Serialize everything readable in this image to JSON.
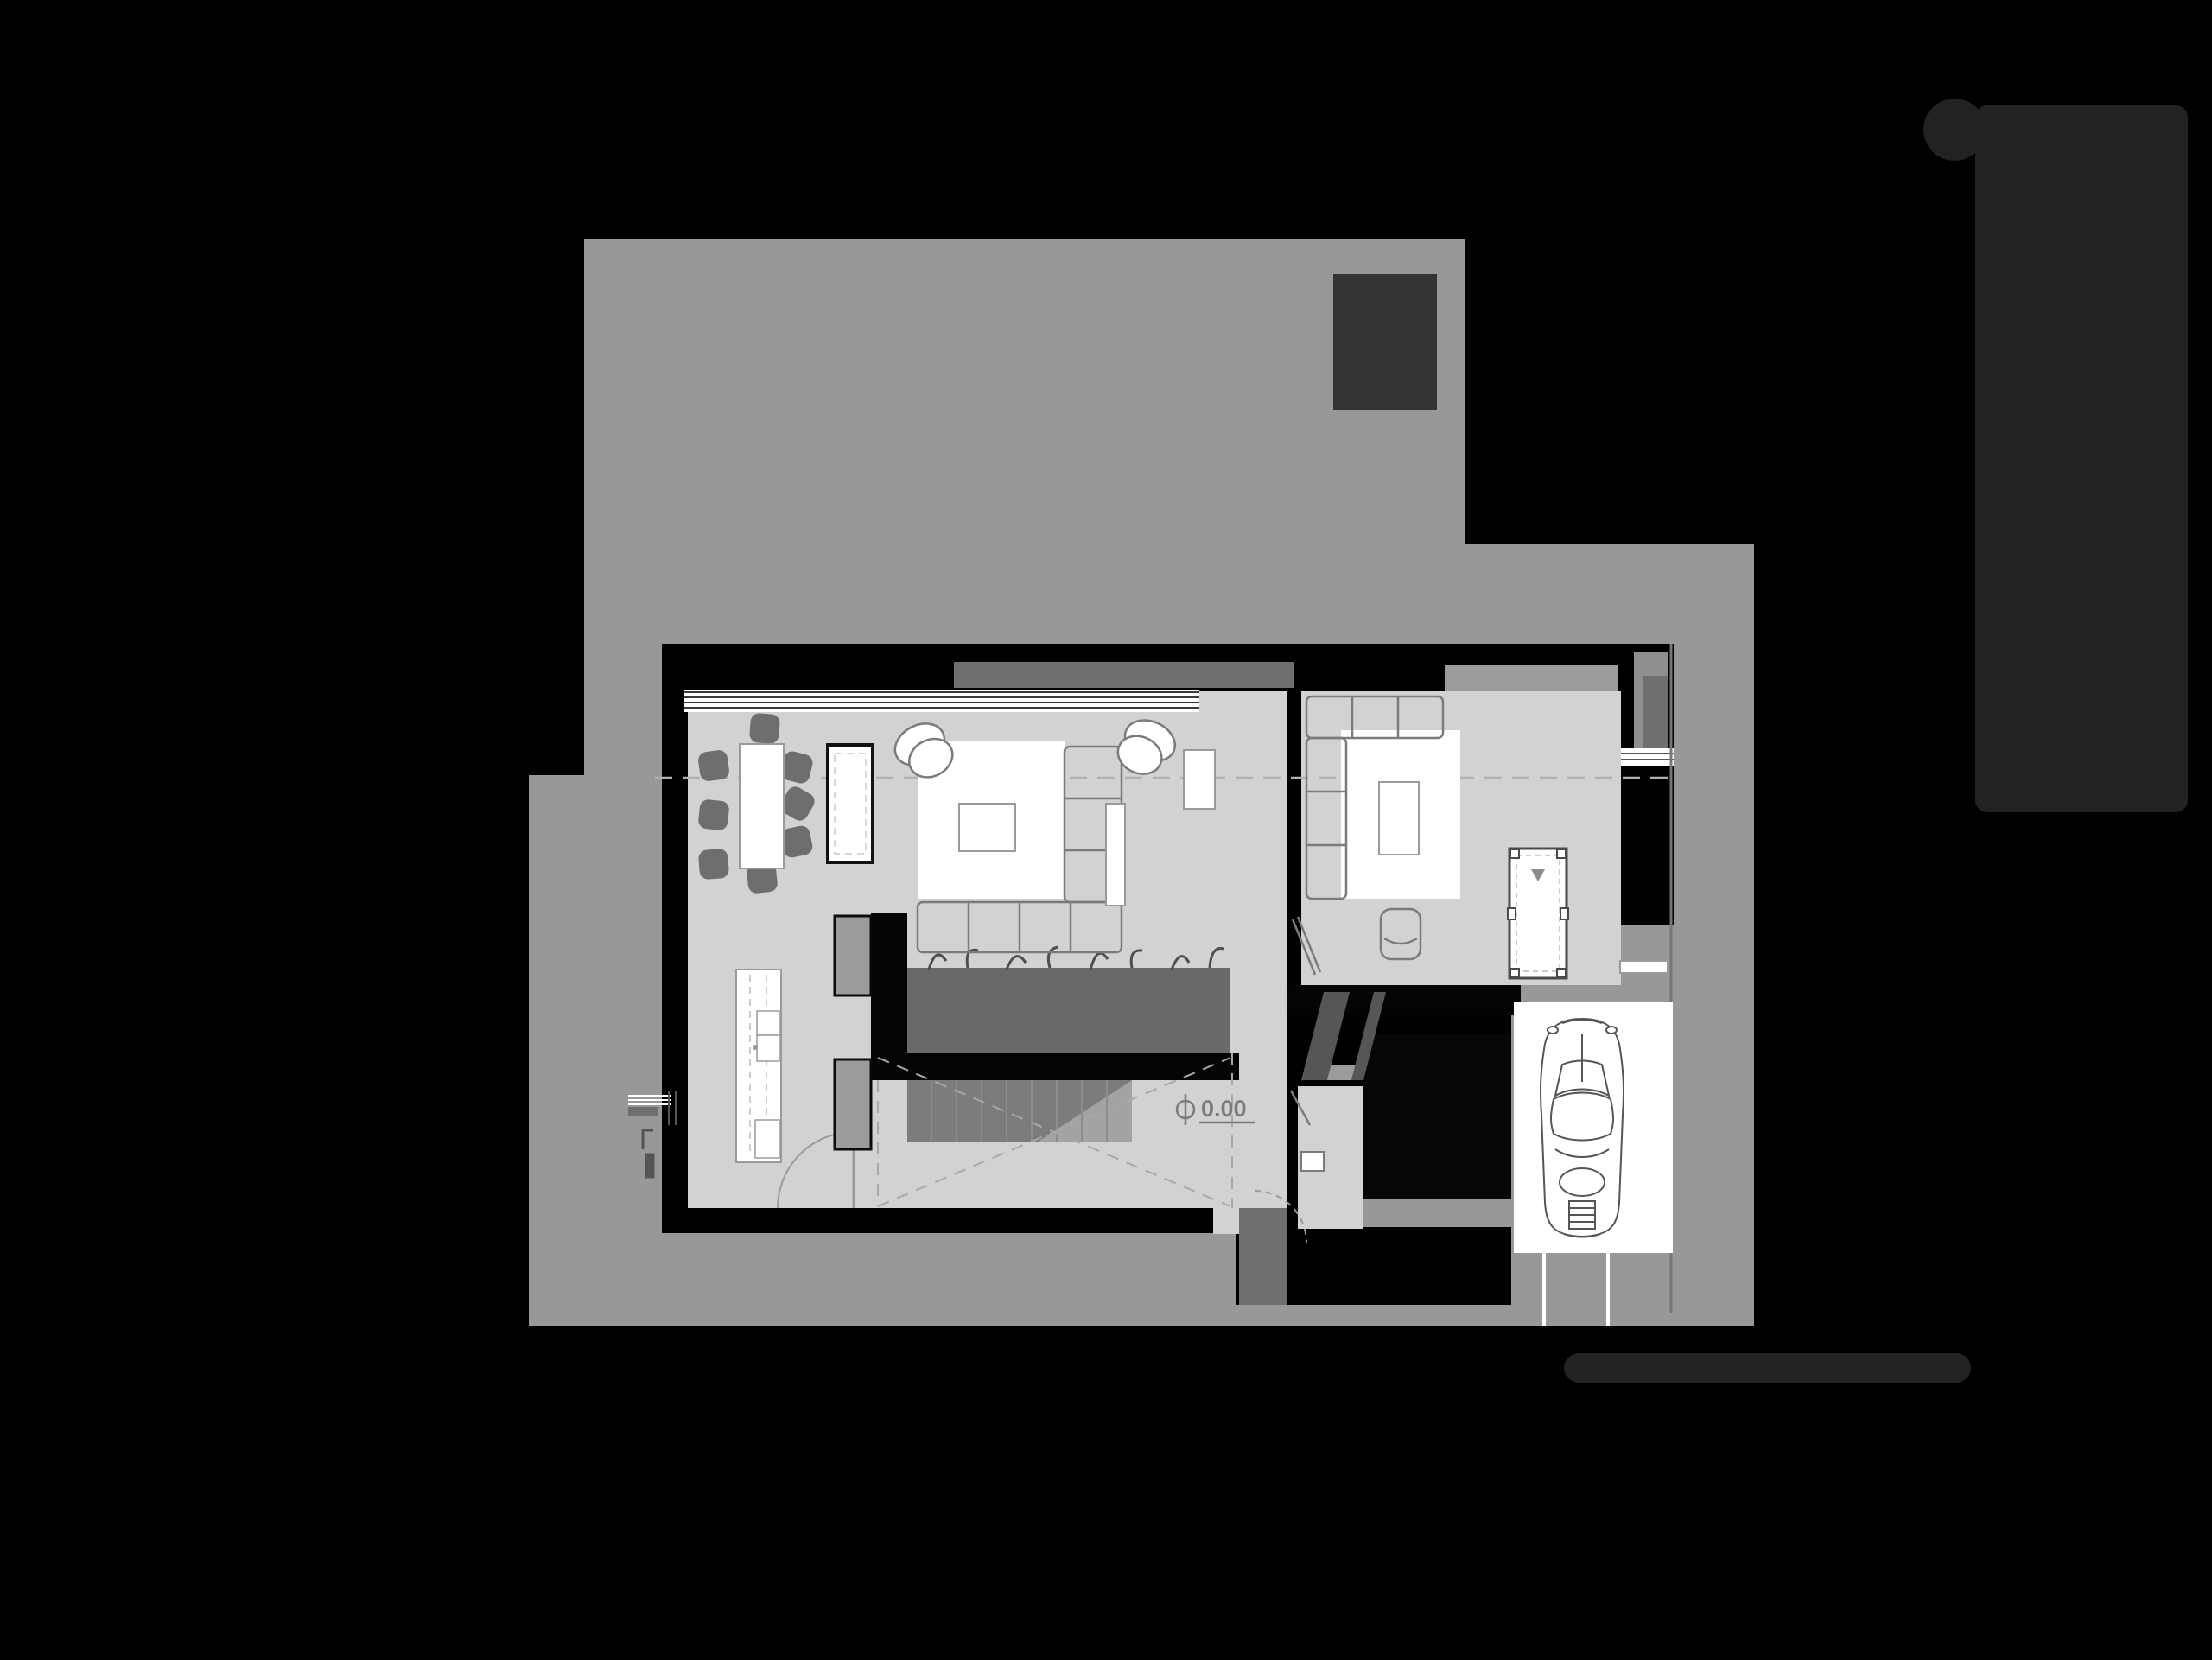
{
  "palette": {
    "background": "#000000",
    "site_gray": "#989898",
    "floor_gray": "#d2d2d2",
    "header_dark_gray": "#6f6f6f",
    "planter_gray": "#696969",
    "stair_light": "#a3a3a3",
    "stair_dark": "#7c7c7c",
    "chair_gray": "#6e6e6e",
    "furniture_stroke": "#7b7b7b",
    "dark_element": "#242122",
    "chimney_gray": "#333235",
    "white": "#ffffff"
  },
  "plan": {
    "level_marker": "0.00",
    "drawing_type": "ground-floor plan",
    "icons": [
      {
        "name": "location-pin-icon"
      },
      {
        "name": "scale-bar"
      },
      {
        "name": "chimney"
      },
      {
        "name": "dining-table-with-chairs",
        "chair_count": 8
      },
      {
        "name": "kitchen-island"
      },
      {
        "name": "sideboard"
      },
      {
        "name": "rug",
        "count": 2
      },
      {
        "name": "sectional-sofa",
        "count": 2
      },
      {
        "name": "lounge-chair",
        "count": 2
      },
      {
        "name": "coffee-table",
        "count": 2
      },
      {
        "name": "side-table"
      },
      {
        "name": "planter"
      },
      {
        "name": "staircase"
      },
      {
        "name": "billiard-table"
      },
      {
        "name": "washer"
      },
      {
        "name": "ramp"
      },
      {
        "name": "car-icon"
      },
      {
        "name": "level-marker"
      },
      {
        "name": "entry-door-arc"
      },
      {
        "name": "section-dash-line"
      }
    ]
  }
}
